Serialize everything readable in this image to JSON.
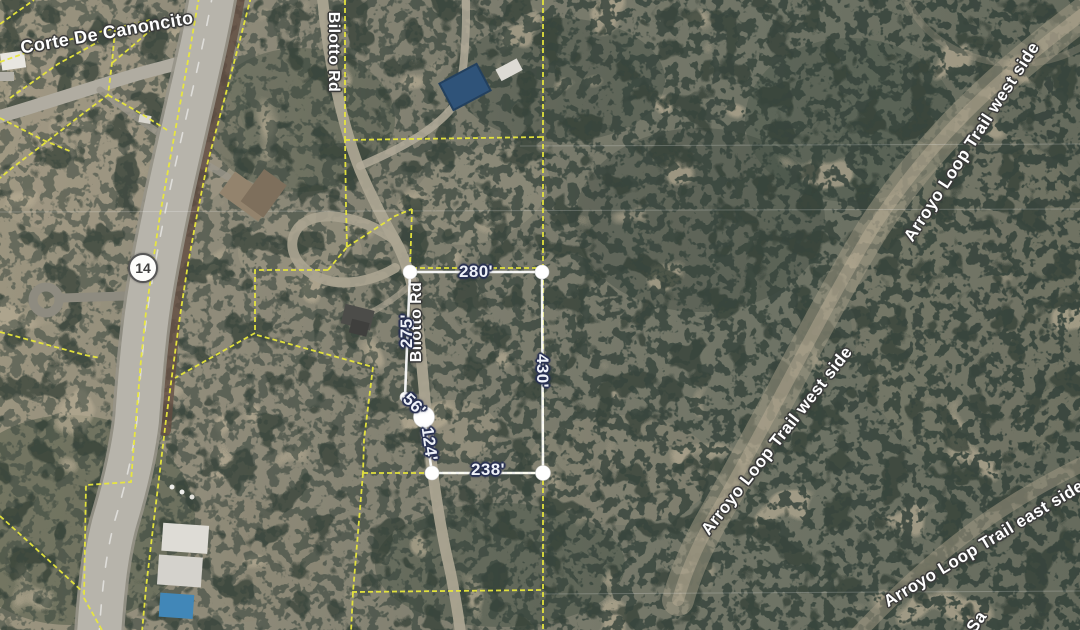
{
  "map": {
    "labels": {
      "corte": "Corte De Canoncito",
      "bilotto_top": "Bilotto Rd",
      "bilotto_mid": "Bilotto Rd",
      "arroyo_west_upper": "Arroyo Loop Trail west side",
      "arroyo_west_lower": "Arroyo Loop Trail west side",
      "arroyo_east": "Arroyo Loop Trail east side",
      "trail_partial": "Sa"
    },
    "shield": {
      "route": "14"
    },
    "measurement": {
      "top": "280'",
      "right": "430'",
      "bottom": "238'",
      "left": "275'",
      "lower_left": "124'",
      "upper_left": "56'"
    },
    "colors": {
      "parcel_line": "#e9e83c",
      "measurement_line": "#ffffff",
      "measurement_text": "#eef1f8",
      "street_text": "#ffffff",
      "shield_text": "#3f3f3f",
      "house_roof_blue": "#2f5379",
      "pool_blue": "#4187b8"
    }
  }
}
